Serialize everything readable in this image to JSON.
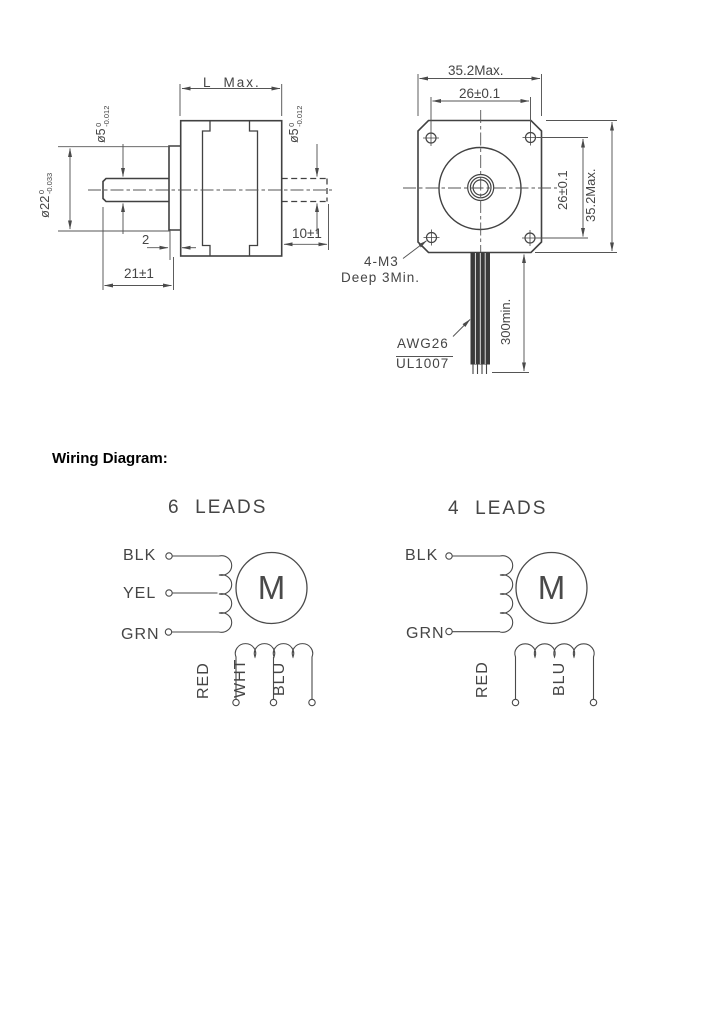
{
  "colors": {
    "background": "#ffffff",
    "ink": "#454545",
    "heading": "#000000",
    "line": "#414141"
  },
  "drawing": {
    "side_view": {
      "length_dim": "L  Max.",
      "front_shaft_dia": {
        "base": "ø5",
        "upper": "0",
        "lower": "-0.012"
      },
      "pilot_dia": {
        "base": "ø22",
        "upper": "0",
        "lower": "-0.033"
      },
      "pilot_depth_dim": "2",
      "front_shaft_len_dim": "21±1",
      "rear_shaft_dia": {
        "base": "ø5",
        "upper": "0",
        "lower": "-0.012"
      },
      "rear_shaft_len_dim": "10±1"
    },
    "front_view": {
      "body_width_dim": "35.2Max.",
      "hole_spacing_h_dim": "26±0.1",
      "hole_spacing_v_dim": "26±0.1",
      "body_height_dim": "35.2Max.",
      "mounting_note_line1": "4-M3",
      "mounting_note_line2": "Deep 3Min.",
      "wire_gauge": "AWG26",
      "wire_type": "UL1007",
      "wire_length_dim": "300min."
    }
  },
  "wiring": {
    "heading": "Wiring Diagram:",
    "six_leads": {
      "title": "6  LEADS",
      "motor": "M",
      "leads_a": [
        "BLK",
        "YEL",
        "GRN"
      ],
      "leads_b": [
        "RED",
        "WHT",
        "BLU"
      ]
    },
    "four_leads": {
      "title": "4  LEADS",
      "motor": "M",
      "leads_a": [
        "BLK",
        "GRN"
      ],
      "leads_b": [
        "RED",
        "BLU"
      ]
    }
  }
}
